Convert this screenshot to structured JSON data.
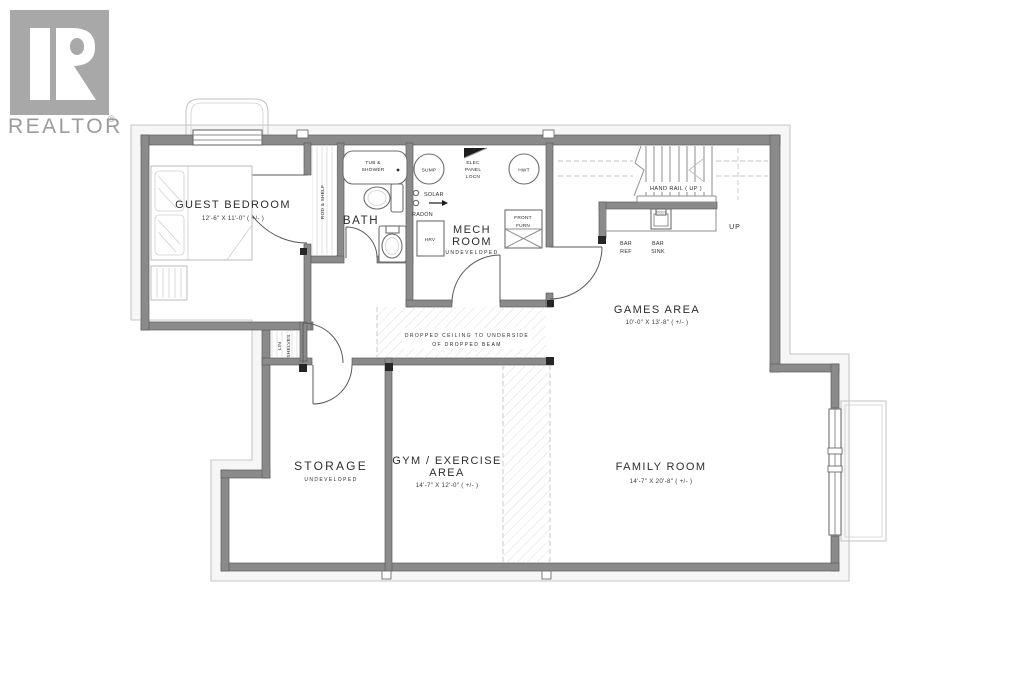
{
  "logo": {
    "brand": "REALTOR",
    "registered": "®",
    "letter": "R",
    "box_color": "#a8a8a8",
    "text_color": "#9b9b9b"
  },
  "plan": {
    "colors": {
      "wall": "#8a8a8a",
      "wall_edge": "#5e5e5e",
      "footing_outline": "#c7c7c7",
      "text": "#2d2d2d",
      "fixture": "#6e6e6e",
      "furniture": "#bdbdbd"
    },
    "rooms": {
      "guest_bedroom": {
        "name": "GUEST BEDROOM",
        "dims": "12'-6\" X 11'-0\" ( +/- )"
      },
      "bath": {
        "name": "BATH"
      },
      "mech_room": {
        "line1": "MECH",
        "line2": "ROOM",
        "status": "UNDEVELOPED"
      },
      "games_area": {
        "name": "GAMES AREA",
        "dims": "10'-0\" X 13'-8\" ( +/- )"
      },
      "storage": {
        "name": "STORAGE",
        "status": "UNDEVELOPED"
      },
      "gym": {
        "line1": "GYM / EXERCISE",
        "line2": "AREA",
        "dims": "14'-7\" X 12'-0\" ( +/- )"
      },
      "family_room": {
        "name": "FAMILY ROOM",
        "dims": "14'-7\" X 20'-8\" ( +/- )"
      }
    },
    "labels": {
      "tub1": "TUB &",
      "tub2": "SHOWER",
      "rod_shelf": "ROD & SHELF",
      "lin1": "LIN",
      "lin2": "SHELVES",
      "sump": "SUMP",
      "hwt": "HWT",
      "hrv": "HRV",
      "elec1": "ELEC",
      "elec2": "PANEL",
      "elec3": "LOCN",
      "solar": "SOLAR",
      "radon": "RADON",
      "front1": "FRONT",
      "front2": "FURN",
      "handrail": "HAND RAIL ( UP )",
      "up": "UP",
      "bar_ref1": "BAR",
      "bar_ref2": "REF",
      "bar_sink1": "BAR",
      "bar_sink2": "SINK",
      "sink_brand": "MOEN",
      "dropped1": "DROPPED CEILING TO UNDERSIDE",
      "dropped2": "OF DROPPED BEAM"
    }
  }
}
